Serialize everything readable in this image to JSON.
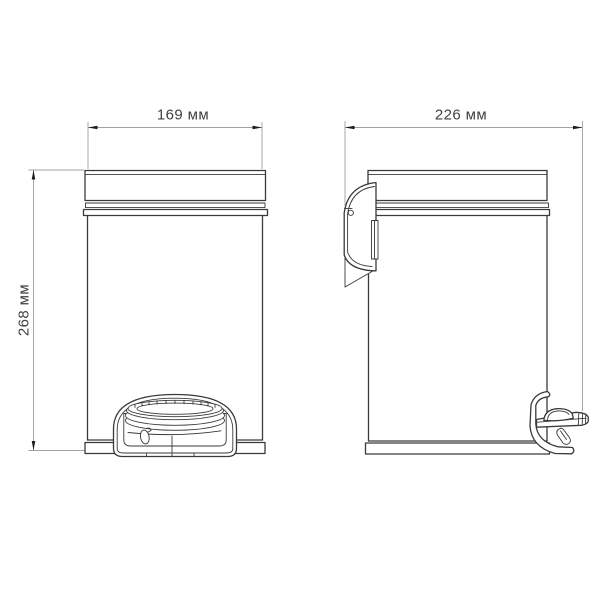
{
  "drawing": {
    "type": "technical-drawing",
    "subject": "pedal waste bin, front and side orthographic views",
    "unit": "мм",
    "dimensions": {
      "front_width": {
        "value": "169",
        "unit": "мм",
        "label": "169 мм"
      },
      "side_depth": {
        "value": "226",
        "unit": "мм",
        "label": "226 мм"
      },
      "height": {
        "value": "268",
        "unit": "мм",
        "label": "268 мм"
      }
    }
  },
  "colors": {
    "background": "#ffffff",
    "outline": "#3a3a3a",
    "dimension_line": "#a0a0a0",
    "arrow": "#1c1c1c",
    "label_text": "#3f3f3f"
  }
}
